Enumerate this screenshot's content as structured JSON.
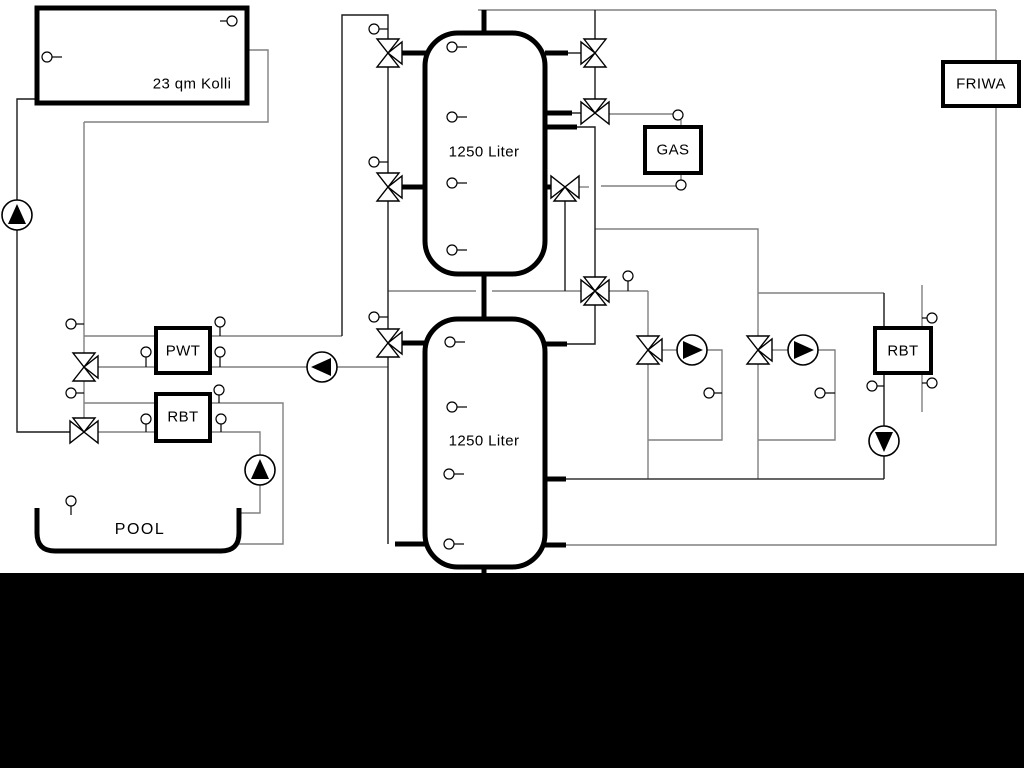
{
  "diagram": {
    "labels": {
      "collector": "23 qm Kolli",
      "tank_top": "1250 Liter",
      "tank_bottom": "1250 Liter",
      "gas": "GAS",
      "friwa": "FRIWA",
      "pwt": "PWT",
      "rbt_left": "RBT",
      "rbt_right": "RBT",
      "pool": "POOL"
    },
    "colors": {
      "pipe_gray": "#808080",
      "pipe_dark": "#1a1a1a",
      "equipment": "#000000",
      "background": "#ffffff",
      "footer_bar": "#000000"
    }
  }
}
